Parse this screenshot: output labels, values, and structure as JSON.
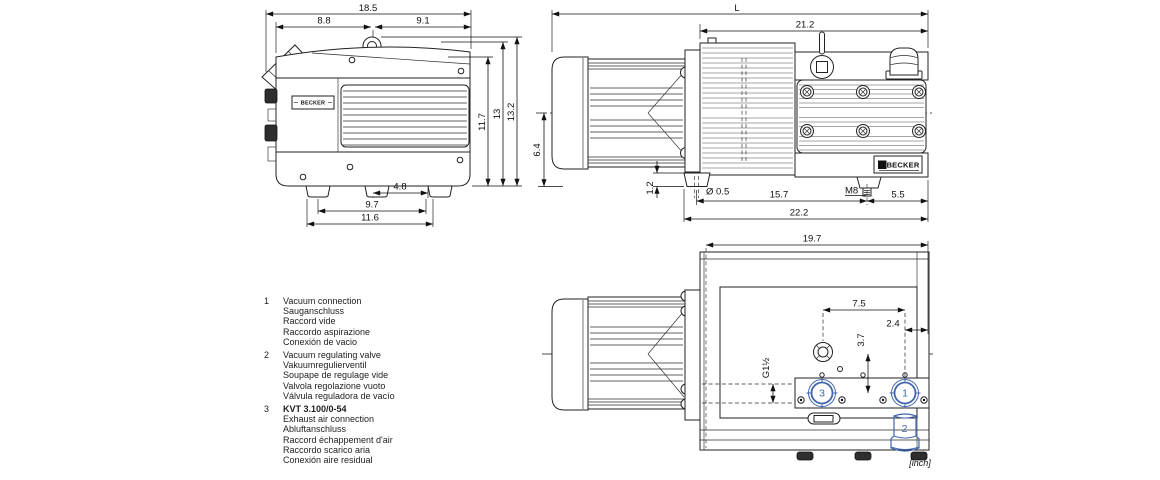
{
  "front_view": {
    "brand": "BECKER",
    "dims": {
      "total_width": "18.5",
      "left_of_eye": "8.8",
      "right_of_eye": "9.1",
      "body_height": "11.7",
      "cover_height": "13",
      "total_height": "13.2",
      "foot_span_center": "4.8",
      "foot_span_mid": "9.7",
      "foot_span_outer": "11.6"
    }
  },
  "side_view": {
    "brand": "BECKER",
    "dims": {
      "total_length": "L",
      "pump_length": "21.2",
      "shaft_height": "6.4",
      "foot_height": "1.2",
      "hole_diameter": "Ø 0.5",
      "hole_to_stud": "15.7",
      "stud_thread": "M8",
      "stud_to_end": "5.5",
      "base_length": "22.2"
    }
  },
  "top_view": {
    "dims": {
      "pump_length": "19.7",
      "eye_to_port": "7.5",
      "port_to_end": "2.4",
      "center_to_port": "3.7",
      "port_thread": "G1½"
    },
    "callouts": {
      "exhaust": "3",
      "vacuum": "1",
      "valve": "2"
    },
    "units_note": "[inch]"
  },
  "legend": {
    "items": [
      {
        "num": "1",
        "lines": [
          "Vacuum connection",
          "Sauganschluss",
          "Raccord vide",
          "Raccordo aspirazione",
          "Conexión de vacio"
        ]
      },
      {
        "num": "2",
        "lines": [
          "Vacuum regulating valve",
          "Vakuumregulierventil",
          "Soupape de regulage vide",
          "Valvola regolazione vuoto",
          "Válvula reguladora de vacío"
        ]
      },
      {
        "num": "3",
        "title": "KVT 3.100/0-54",
        "lines": [
          "Exhaust air connection",
          "Abluftanschluss",
          "Raccord échappement d'air",
          "Raccordo scarico aria",
          "Conexión aire residual"
        ]
      }
    ]
  },
  "colors": {
    "line": "#222222",
    "callout": "#4066ad"
  }
}
